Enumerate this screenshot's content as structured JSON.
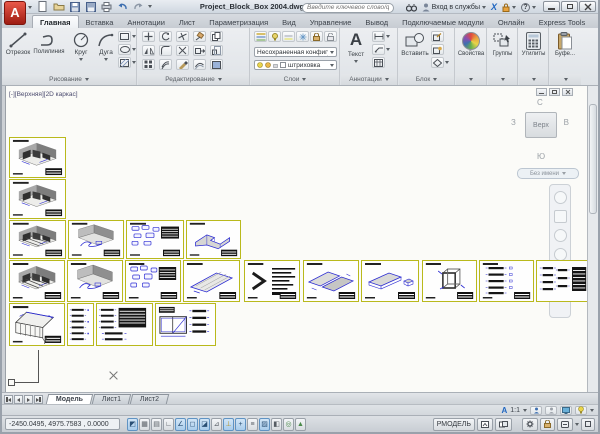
{
  "titlebar": {
    "logo_letter": "A",
    "title": "Project_Block_Box 2004.dwg",
    "search_placeholder": "Введите ключевое слово/фразу",
    "signin_label": "Вход в службы",
    "exchange_icon": "X",
    "help_icon": "?"
  },
  "ribbon": {
    "tabs": [
      {
        "label": "Главная",
        "active": true
      },
      {
        "label": "Вставка"
      },
      {
        "label": "Аннотации"
      },
      {
        "label": "Лист"
      },
      {
        "label": "Параметризация"
      },
      {
        "label": "Вид"
      },
      {
        "label": "Управление"
      },
      {
        "label": "Вывод"
      },
      {
        "label": "Подключаемые модули"
      },
      {
        "label": "Онлайн"
      },
      {
        "label": "Express Tools"
      }
    ],
    "panels": {
      "draw": {
        "label": "Рисование",
        "tools": [
          {
            "label": "Отрезок"
          },
          {
            "label": "Полилиния"
          },
          {
            "label": "Круг"
          },
          {
            "label": "Дуга"
          }
        ]
      },
      "modify": {
        "label": "Редактирование"
      },
      "layers": {
        "label": "Слои",
        "config_value": "Несохраненная конфигурация сло",
        "layer_value": "штриховка"
      },
      "annotation": {
        "label": "Аннотации",
        "text_label": "Текст",
        "text_icon": "A"
      },
      "block": {
        "label": "Блок",
        "insert_label": "Вставить"
      },
      "properties": {
        "label": "Свойства"
      },
      "groups": {
        "label": "Группы"
      },
      "utilities": {
        "label": "Утилиты"
      },
      "clipboard": {
        "label": "Буфе..."
      }
    }
  },
  "viewport": {
    "label": "[-][Верхняя][2D каркас]",
    "ucs_axis_label": "Y",
    "viewcube": {
      "north": "С",
      "south": "Ю",
      "west": "З",
      "east": "В",
      "top_face": "Верх",
      "wcs": "Без имени"
    }
  },
  "layout_bar": {
    "tabs": [
      {
        "label": "Модель",
        "active": true
      },
      {
        "label": "Лист1"
      },
      {
        "label": "Лист2"
      }
    ]
  },
  "statusbar": {
    "coordinates": "-2450.0495, 4975.7583 , 0.0000",
    "annotation_scale_icon": "А",
    "annotation_scale": "1:1",
    "model_space_label": "РМОДЕЛЬ",
    "toggles": [
      {
        "name": "infer-constraints",
        "glyph": "◩",
        "active": true
      },
      {
        "name": "snap",
        "glyph": "▦",
        "active": false
      },
      {
        "name": "grid",
        "glyph": "▤",
        "active": false
      },
      {
        "name": "ortho",
        "glyph": "∟",
        "active": false
      },
      {
        "name": "polar-tracking",
        "glyph": "∠",
        "active": true
      },
      {
        "name": "osnap",
        "glyph": "◻",
        "active": true
      },
      {
        "name": "osnap-3d",
        "glyph": "◪",
        "active": true
      },
      {
        "name": "otrack",
        "glyph": "⊿",
        "active": false
      },
      {
        "name": "dynamic-ucs",
        "glyph": "⊥",
        "active": true
      },
      {
        "name": "dynamic-input",
        "glyph": "+",
        "active": true
      },
      {
        "name": "lineweight",
        "glyph": "≡",
        "active": false
      },
      {
        "name": "transparency",
        "glyph": "▨",
        "active": true
      },
      {
        "name": "quick-properties",
        "glyph": "◧",
        "active": false
      },
      {
        "name": "selection-cycling",
        "glyph": "◎",
        "active": false
      },
      {
        "name": "annotation-monitor",
        "glyph": "▲",
        "active": false
      }
    ]
  }
}
